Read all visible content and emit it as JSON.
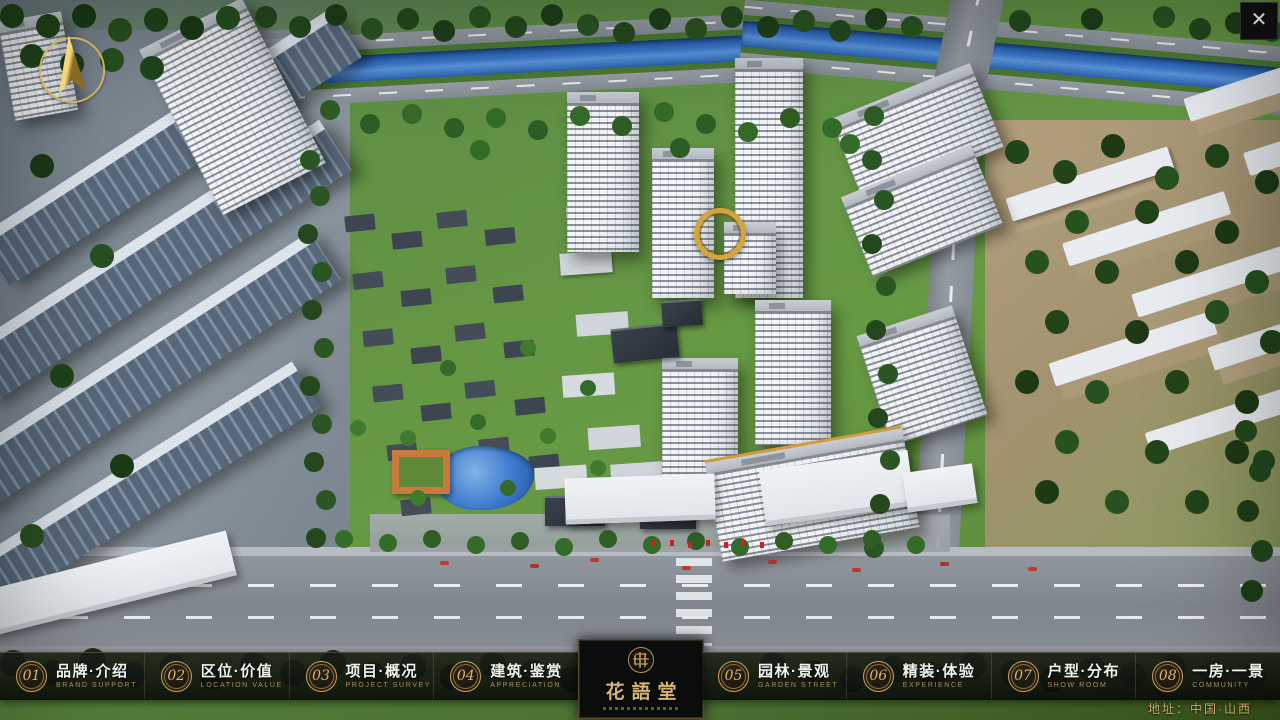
{
  "window": {
    "close_icon": "✕"
  },
  "icons": {
    "compass": "north-arrow",
    "close": "x-mark",
    "logo_seal": "round-seal-emblem"
  },
  "logo": {
    "title": "花語堂"
  },
  "nav": {
    "items": [
      {
        "number": "01",
        "title": "品牌·介绍",
        "subtitle": "BRAND SUPPORT"
      },
      {
        "number": "02",
        "title": "区位·价值",
        "subtitle": "LOCATION VALUE"
      },
      {
        "number": "03",
        "title": "项目·概况",
        "subtitle": "PROJECT SURVEY"
      },
      {
        "number": "04",
        "title": "建筑·鉴赏",
        "subtitle": "APPRECIATION"
      },
      {
        "number": "05",
        "title": "园林·景观",
        "subtitle": "GARDEN STREET"
      },
      {
        "number": "06",
        "title": "精装·体验",
        "subtitle": "EXPERIENCE"
      },
      {
        "number": "07",
        "title": "户型·分布",
        "subtitle": "SHOW ROOM"
      },
      {
        "number": "08",
        "title": "一房·一景",
        "subtitle": "COMMUNITY"
      }
    ]
  },
  "footer": {
    "address": "地址：中国·山西"
  },
  "colors": {
    "gold": "#C9A264",
    "gold_dark": "#8A6F3F",
    "navbar_bg": "rgba(10,12,10,0.85)",
    "river_blue": "#3B78CC",
    "grass_green": "#679A44",
    "tree_dark_green": "#24471D",
    "road_gray": "#8A9097",
    "building_white": "#EDF0F3",
    "window_dark": "#39434E"
  }
}
